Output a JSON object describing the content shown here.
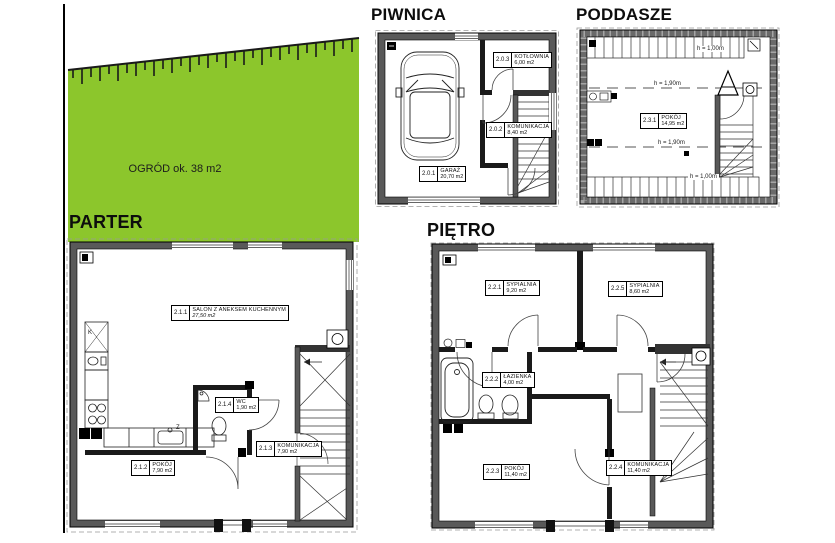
{
  "colors": {
    "garden_green": "#8cc62c",
    "wall_gray": "#595959",
    "wall_dark": "#1a1a1a",
    "title_black": "#0d0d0d"
  },
  "garden": {
    "label": "OGRÓD ok. 38 m2"
  },
  "floors": {
    "piwnica": {
      "title": "PIWNICA",
      "rooms": [
        {
          "num": "2.0.1",
          "name": "GARAŻ",
          "area": "20,70 m2"
        },
        {
          "num": "2.0.2",
          "name": "KOMUNIKACJA",
          "area": "8,40 m2"
        },
        {
          "num": "2.0.3",
          "name": "KOTŁOWNIA",
          "area": "6,00 m2"
        }
      ]
    },
    "parter": {
      "title": "PARTER",
      "rooms": [
        {
          "num": "2.1.1",
          "name": "SALON Z ANEKSEM KUCHENNYM",
          "area": "27,50 m2"
        },
        {
          "num": "2.1.2",
          "name": "POKÓJ",
          "area": "7,90 m2"
        },
        {
          "num": "2.1.3",
          "name": "KOMUNIKACJA",
          "area": "7,90 m2"
        },
        {
          "num": "2.1.4",
          "name": "WC",
          "area": "1,90 m2"
        }
      ],
      "fixture_letters": {
        "k": "K",
        "z": "Z"
      }
    },
    "pietro": {
      "title": "PIĘTRO",
      "rooms": [
        {
          "num": "2.2.1",
          "name": "SYPIALNIA",
          "area": "9,20 m2"
        },
        {
          "num": "2.2.2",
          "name": "ŁAZIENKA",
          "area": "4,00 m2"
        },
        {
          "num": "2.2.3",
          "name": "POKÓJ",
          "area": "11,40 m2"
        },
        {
          "num": "2.2.4",
          "name": "KOMUNIKACJA",
          "area": "11,40 m2"
        },
        {
          "num": "2.2.5",
          "name": "SYPIALNIA",
          "area": "8,60 m2"
        }
      ]
    },
    "poddasze": {
      "title": "PODDASZE",
      "rooms": [
        {
          "num": "2.3.1",
          "name": "POKÓJ",
          "area": "14,95 m2"
        }
      ],
      "heights": [
        "h = 1,00m",
        "h = 1,90m",
        "h = 1,90m",
        "h = 1,00m"
      ]
    }
  },
  "icons": [
    "car-icon",
    "stairs-icon",
    "bathtub-icon",
    "toilet-icon",
    "bidet-icon",
    "sink-icon",
    "stove-icon",
    "fridge-icon",
    "fence-icon",
    "wardrobe-icon",
    "ladder-icon",
    "vent-icon",
    "boiler-icon"
  ]
}
